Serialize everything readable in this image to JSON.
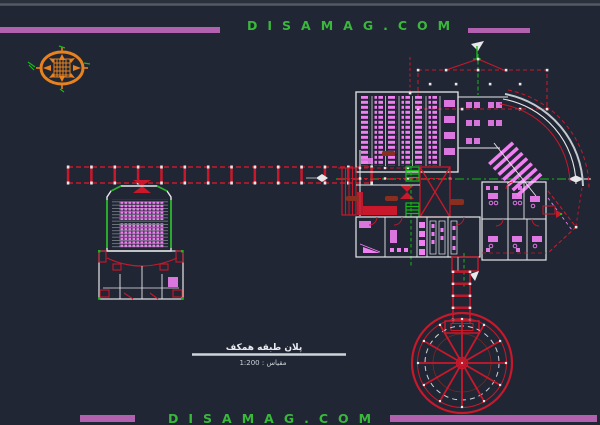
{
  "page": {
    "background": "#202634",
    "top_rule_color": "#565b63"
  },
  "watermark": {
    "top_text": "DISAMAG.COM",
    "bottom_text": "DISAMAG.COM",
    "text_color": "#38b93a",
    "bar_color": "#b261ae"
  },
  "title_block": {
    "plan_title": "پلان طبقه همکف",
    "scale_text": "مقیاس : 1:200"
  },
  "drawing": {
    "colors": {
      "walls_white": "#e8e8ea",
      "furniture_magenta": "#f07ff2",
      "structure_red": "#c9182b",
      "axis_green": "#18b818",
      "compass_orange": "#e8821e",
      "arc_silver": "#c3c9cf",
      "couch_darkred": "#8a2f20"
    }
  }
}
